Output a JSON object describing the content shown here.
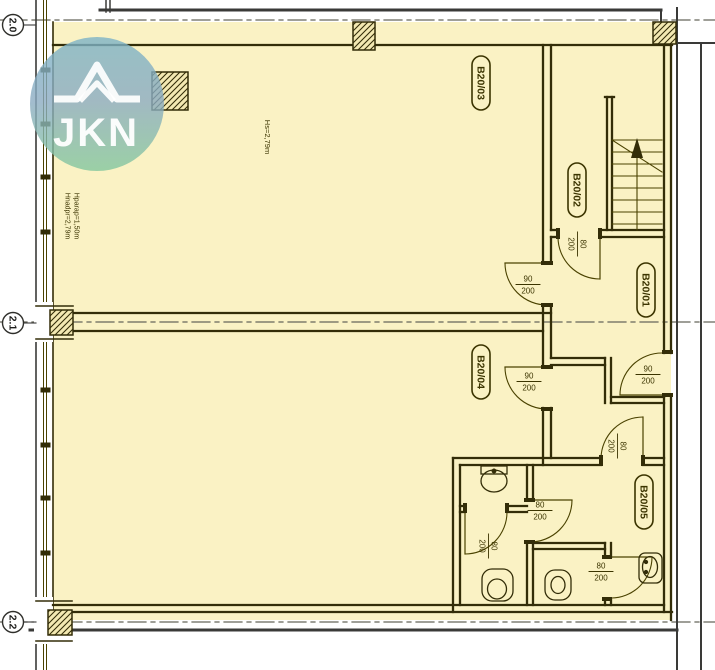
{
  "title": "Apartment floor plan B20",
  "palette": {
    "floor": "#FAF2C4",
    "column_fill": "#F3E9B2",
    "wall": "#332D08",
    "thin": "#4A4200",
    "slab": "#3A3A38",
    "grid": "#66665A",
    "text": "#3B3400",
    "white": "#FFFFFF"
  },
  "watermark": {
    "text": "JKN",
    "cx": 97,
    "cy": 104,
    "r": 67,
    "gradient_top": "#7CB3C6",
    "gradient_mid": "#8BABC2",
    "gradient_bottom": "#83C79E",
    "roof_outer": "M54,99 L77,99 L97,65 L117,99 L140,99",
    "roof_inner": "M80,101 L97,83 L114,101"
  },
  "grid_markers": [
    {
      "label": "2.0",
      "cx": 13,
      "cy": 25,
      "line_y": 20
    },
    {
      "label": "2.1",
      "cx": 13,
      "cy": 323,
      "line_y": 322
    },
    {
      "label": "2.2",
      "cx": 13,
      "cy": 622,
      "line_y": 622
    }
  ],
  "rooms": [
    {
      "id": "B20/01",
      "cx": 646,
      "cy": 290
    },
    {
      "id": "B20/02",
      "cx": 577,
      "cy": 190
    },
    {
      "id": "B20/03",
      "cx": 481,
      "cy": 83
    },
    {
      "id": "B20/04",
      "cx": 481,
      "cy": 372
    },
    {
      "id": "B20/05",
      "cx": 644,
      "cy": 502
    }
  ],
  "height_annotations": [
    {
      "text": "Hs=2,79m",
      "x": 265,
      "y": 137,
      "size": 7.5
    },
    {
      "text": "Hnadpr=2,79m",
      "x": 65.5,
      "y": 216,
      "size": 7
    },
    {
      "text": "Hparap=1,50m",
      "x": 74.5,
      "y": 216,
      "size": 7
    }
  ],
  "door_labels": [
    {
      "w": "90",
      "h": "200",
      "x": 528,
      "y": 284,
      "rotated": false
    },
    {
      "w": "90",
      "h": "200",
      "x": 648,
      "y": 374,
      "rotated": false
    },
    {
      "w": "90",
      "h": "200",
      "x": 529,
      "y": 381,
      "rotated": false
    },
    {
      "w": "80",
      "h": "200",
      "x": 578,
      "y": 244,
      "rotated": true
    },
    {
      "w": "80",
      "h": "200",
      "x": 618,
      "y": 446,
      "rotated": true
    },
    {
      "w": "80",
      "h": "200",
      "x": 540,
      "y": 510,
      "rotated": false
    },
    {
      "w": "80",
      "h": "200",
      "x": 489,
      "y": 546,
      "rotated": true
    },
    {
      "w": "80",
      "h": "200",
      "x": 601,
      "y": 571,
      "rotated": false
    }
  ],
  "geometry": {
    "floor": [
      53,
      22,
      618,
      598
    ],
    "grid_lines_y": [
      20,
      322,
      622
    ],
    "columns": [
      [
        152,
        72,
        36,
        38
      ],
      [
        353,
        22,
        22,
        28
      ],
      [
        653,
        22,
        23,
        22
      ],
      [
        50,
        310,
        23,
        25
      ],
      [
        48,
        610,
        24,
        25
      ]
    ],
    "walls_heavy": [
      [
        53,
        45,
        672,
        45
      ],
      [
        543,
        45,
        543,
        263
      ],
      [
        543,
        305,
        543,
        367
      ],
      [
        543,
        408,
        543,
        465
      ],
      [
        551,
        45,
        551,
        230
      ],
      [
        551,
        237,
        551,
        263
      ],
      [
        551,
        305,
        551,
        358
      ],
      [
        551,
        408,
        551,
        458
      ],
      [
        551,
        230,
        558,
        230
      ],
      [
        600,
        230,
        664,
        230
      ],
      [
        551,
        237,
        558,
        237
      ],
      [
        600,
        237,
        664,
        237
      ],
      [
        558,
        230,
        558,
        237
      ],
      [
        600,
        230,
        600,
        237
      ],
      [
        73,
        313,
        551,
        313
      ],
      [
        73,
        331,
        543,
        331
      ],
      [
        551,
        358,
        605,
        358
      ],
      [
        551,
        365,
        605,
        365
      ],
      [
        605,
        358,
        605,
        403
      ],
      [
        611,
        358,
        611,
        403
      ],
      [
        611,
        397,
        664,
        397
      ],
      [
        611,
        403,
        664,
        403
      ],
      [
        453,
        458,
        601,
        458
      ],
      [
        643,
        458,
        664,
        458
      ],
      [
        460,
        465,
        601,
        465
      ],
      [
        643,
        465,
        664,
        465
      ],
      [
        453,
        458,
        453,
        612
      ],
      [
        460,
        465,
        460,
        605
      ],
      [
        527,
        465,
        527,
        500
      ],
      [
        533,
        465,
        533,
        500
      ],
      [
        527,
        542,
        527,
        605
      ],
      [
        533,
        542,
        533,
        605
      ],
      [
        460,
        506,
        465,
        506
      ],
      [
        507,
        506,
        527,
        506
      ],
      [
        460,
        512,
        465,
        512
      ],
      [
        507,
        512,
        527,
        512
      ],
      [
        533,
        543,
        605,
        543
      ],
      [
        533,
        549,
        605,
        549
      ],
      [
        605,
        543,
        605,
        557
      ],
      [
        611,
        543,
        611,
        557
      ],
      [
        605,
        599,
        605,
        605
      ],
      [
        611,
        599,
        611,
        605
      ],
      [
        53,
        605,
        664,
        605
      ],
      [
        53,
        612,
        672,
        612
      ],
      [
        664,
        45,
        664,
        353
      ],
      [
        664,
        395,
        664,
        612
      ],
      [
        671,
        45,
        671,
        353
      ],
      [
        671,
        395,
        671,
        620
      ],
      [
        607,
        97,
        607,
        230
      ],
      [
        612,
        97,
        612,
        230
      ],
      [
        605,
        97,
        614,
        97
      ]
    ],
    "door_leaves": [
      [
        600,
        237,
        600,
        279
      ],
      [
        505,
        263,
        547,
        263
      ],
      [
        620,
        395,
        662,
        395
      ],
      [
        505,
        367,
        547,
        367
      ],
      [
        643,
        417,
        643,
        458
      ],
      [
        530,
        500,
        572,
        500
      ],
      [
        465,
        512,
        465,
        554
      ],
      [
        611,
        557,
        652,
        557
      ]
    ],
    "door_arcs": [
      "M600,279 A42,42 0 0 1 558,237",
      "M505,263 A42,42 0 0 0 547,305",
      "M620,395 A42,42 0 0 1 662,353",
      "M505,367 A42,42 0 0 0 547,409",
      "M643,417 A42,42 0 0 0 601,458",
      "M572,500 A42,42 0 0 1 530,542",
      "M465,554 A42,42 0 0 0 507,512",
      "M652,557 A41,41 0 0 1 611,598"
    ],
    "door_jambs": [
      [
        556,
        228,
        4,
        11
      ],
      [
        598,
        228,
        4,
        11
      ],
      [
        541,
        261,
        12,
        4
      ],
      [
        541,
        303,
        12,
        4
      ],
      [
        662,
        350,
        11,
        4
      ],
      [
        662,
        393,
        11,
        4
      ],
      [
        541,
        365,
        12,
        4
      ],
      [
        541,
        407,
        12,
        4
      ],
      [
        599,
        455,
        4,
        11
      ],
      [
        641,
        455,
        4,
        11
      ],
      [
        524,
        498,
        11,
        4
      ],
      [
        524,
        540,
        11,
        4
      ],
      [
        463,
        503,
        4,
        10
      ],
      [
        505,
        503,
        4,
        10
      ],
      [
        602,
        555,
        10,
        4
      ],
      [
        602,
        597,
        10,
        4
      ]
    ],
    "stairs": {
      "tread_x": [
        612,
        662
      ],
      "tread_y": [
        140,
        152,
        164,
        176,
        188,
        200,
        212,
        224
      ],
      "mid_line": [
        637,
        148,
        637,
        230
      ],
      "diagonal": [
        612,
        140,
        662,
        172
      ],
      "arrow_points": "637,138 631,158 643,158"
    },
    "window_wall": {
      "verticals": [
        [
          36,
          0,
          36,
          670,
          "slab",
          1.6
        ],
        [
          43.5,
          0,
          43.5,
          670,
          "thin",
          1
        ],
        [
          46.5,
          0,
          46.5,
          670,
          "thin",
          1
        ],
        [
          53,
          22,
          53,
          620,
          "wall",
          1.6
        ]
      ],
      "mullion_y": [
        70,
        124,
        177,
        232,
        390,
        445,
        498,
        553
      ],
      "break_rects": [
        [
          34,
          302,
          19,
          40
        ],
        [
          34,
          597,
          19,
          47
        ]
      ],
      "frame_lines": [
        [
          36,
          306,
          73,
          306
        ],
        [
          36,
          339,
          73,
          339
        ],
        [
          36,
          601,
          72,
          601
        ],
        [
          36,
          641,
          72,
          641
        ]
      ]
    },
    "exterior_lines": [
      [
        100,
        10,
        661,
        10,
        3
      ],
      [
        661,
        10,
        661,
        21,
        2
      ],
      [
        677,
        8,
        677,
        670,
        2
      ],
      [
        701,
        43,
        701,
        670,
        2
      ],
      [
        677,
        43,
        715,
        43,
        2
      ],
      [
        30,
        630,
        677,
        630,
        3
      ],
      [
        106,
        0,
        106,
        12,
        1.5
      ],
      [
        110,
        0,
        110,
        12,
        1.5
      ]
    ],
    "fixtures": {
      "sink_top": {
        "basin": [
          494,
          481,
          13,
          11
        ],
        "box": [
          481,
          466,
          26,
          8
        ],
        "tap": [
          494,
          471
        ]
      },
      "sink_corridor": {
        "box": [
          639,
          553,
          23,
          30
        ],
        "basin": [
          650,
          567,
          7.5,
          10.5
        ],
        "taps": [
          [
            646,
            562
          ],
          [
            646,
            572
          ]
        ]
      },
      "toilet_left": {
        "body": [
          482,
          569,
          31,
          32
        ],
        "bowl": [
          497,
          589,
          9.5,
          10
        ]
      },
      "toilet_mid": {
        "body": [
          545,
          570,
          26,
          30
        ],
        "bowl": [
          558,
          585,
          7,
          8.5
        ]
      }
    }
  }
}
